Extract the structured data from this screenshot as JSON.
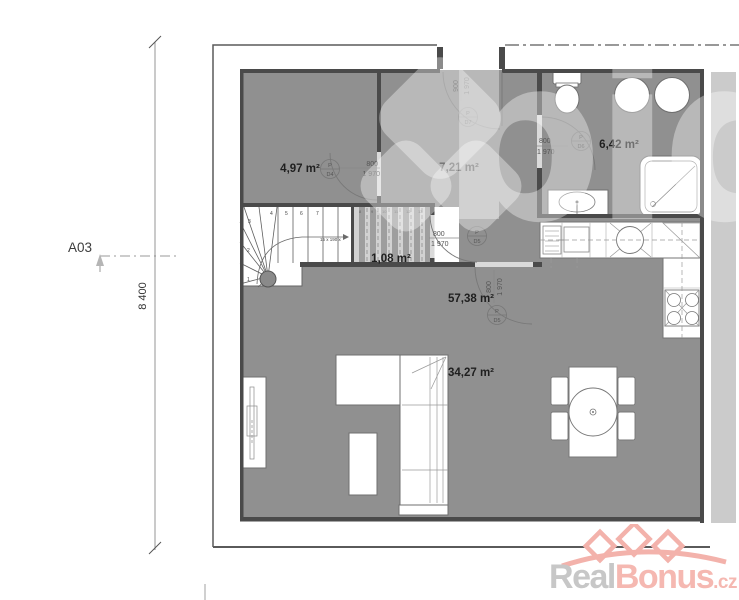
{
  "marker": "A03",
  "left_dimension": "8 400",
  "rooms": [
    {
      "name": "room-top-left",
      "area": "4,97 m²"
    },
    {
      "name": "hall",
      "area": "7,21 m²"
    },
    {
      "name": "bathroom",
      "area": "6,42 m²"
    },
    {
      "name": "closet",
      "area": "1,08 m²"
    },
    {
      "name": "living-kitchen",
      "area": "57,38 m²"
    },
    {
      "name": "living-zone",
      "area": "34,27 m²"
    }
  ],
  "doors": [
    {
      "id": "entry",
      "tag": "P",
      "code": "D7",
      "width": "900",
      "height": "1 970"
    },
    {
      "id": "room-top-left",
      "tag": "P",
      "code": "D4",
      "width": "800",
      "height": "1 970"
    },
    {
      "id": "bathroom",
      "tag": "P",
      "code": "D6",
      "width": "800",
      "height": "1 970"
    },
    {
      "id": "closet",
      "tag": "P",
      "code": "D5",
      "width": "800",
      "height": "1 970"
    },
    {
      "id": "living",
      "tag": "P",
      "code": "D5",
      "width": "800",
      "height": "1 970"
    }
  ],
  "stairs": {
    "step_numbers": [
      "1",
      "2",
      "3",
      "4",
      "5",
      "6",
      "7"
    ],
    "upper_step_numbers": [
      "8",
      "9",
      "10",
      "11",
      "12",
      "13"
    ],
    "dimension_note": "15 x 190 x"
  },
  "watermark_text": "bidli",
  "logo": {
    "gray": "Real",
    "red": "Bonus",
    "suffix": ".cz"
  },
  "colors": {
    "floor": "#909090",
    "wall": "#4a4a4a",
    "accent_red": "#f5b8b1",
    "light_strip": "#cbcbcb"
  }
}
